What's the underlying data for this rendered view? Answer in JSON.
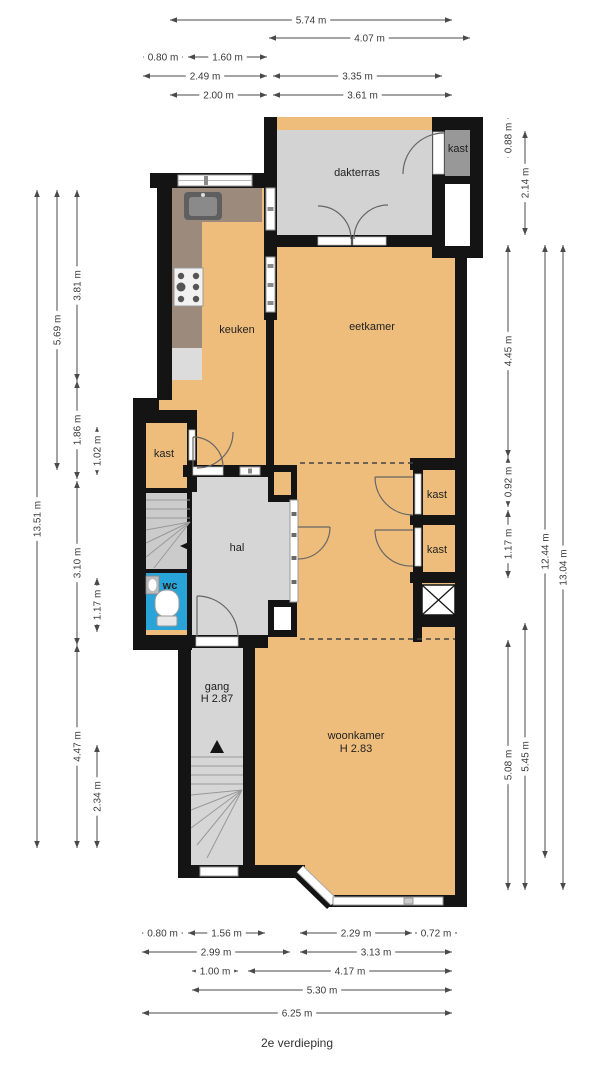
{
  "title": "2e verdieping",
  "colors": {
    "floor_orange": "#efbd7b",
    "floor_gray": "#d5d5d5",
    "wall_black": "#141414",
    "counter_taupe": "#9c8b7d",
    "kast_dark_gray": "#989898",
    "wc_blue": "#29a4d9",
    "dimension_text": "#3a3a3a"
  },
  "floor_plan": {
    "room_labels": [
      {
        "text": "dakterras",
        "x": 357,
        "y": 176
      },
      {
        "text": "kast",
        "x": 458,
        "y": 152
      },
      {
        "text": "keuken",
        "x": 237,
        "y": 333
      },
      {
        "text": "eetkamer",
        "x": 372,
        "y": 330
      },
      {
        "text": "kast",
        "x": 164,
        "y": 457
      },
      {
        "text": "hal",
        "x": 237,
        "y": 551
      },
      {
        "text": "wc",
        "x": 170,
        "y": 589,
        "color": "#ffffff",
        "size": 9,
        "bold": true
      },
      {
        "text": "kast",
        "x": 437,
        "y": 498
      },
      {
        "text": "kast",
        "x": 437,
        "y": 553
      },
      {
        "text": "gang",
        "x": 217,
        "y": 690
      },
      {
        "text": "H 2.87",
        "x": 217,
        "y": 702
      },
      {
        "text": "woonkamer",
        "x": 356,
        "y": 739
      },
      {
        "text": "H 2.83",
        "x": 356,
        "y": 752
      }
    ],
    "dimensions": {
      "horizontal": [
        {
          "label": "5.74 m",
          "x1": 170,
          "x2": 452,
          "y": 20
        },
        {
          "label": "4.07 m",
          "x1": 269,
          "x2": 470,
          "y": 38
        },
        {
          "label": "0.80 m",
          "x1": 143,
          "x2": 183,
          "y": 57
        },
        {
          "label": "1.60 m",
          "x1": 188,
          "x2": 267,
          "y": 57
        },
        {
          "label": "2.49 m",
          "x1": 143,
          "x2": 267,
          "y": 76
        },
        {
          "label": "3.35 m",
          "x1": 273,
          "x2": 442,
          "y": 76
        },
        {
          "label": "2.00 m",
          "x1": 170,
          "x2": 267,
          "y": 95
        },
        {
          "label": "3.61 m",
          "x1": 273,
          "x2": 452,
          "y": 95
        },
        {
          "label": "0.80 m",
          "x1": 142,
          "x2": 183,
          "y": 933
        },
        {
          "label": "1.56 m",
          "x1": 188,
          "x2": 265,
          "y": 933
        },
        {
          "label": "2.29 m",
          "x1": 300,
          "x2": 412,
          "y": 933
        },
        {
          "label": "0.72 m",
          "x1": 415,
          "x2": 457,
          "y": 933
        },
        {
          "label": "2.99 m",
          "x1": 142,
          "x2": 290,
          "y": 952
        },
        {
          "label": "3.13 m",
          "x1": 300,
          "x2": 452,
          "y": 952
        },
        {
          "label": "1.00 m",
          "x1": 192,
          "x2": 238,
          "y": 971
        },
        {
          "label": "4.17 m",
          "x1": 248,
          "x2": 452,
          "y": 971
        },
        {
          "label": "5.30 m",
          "x1": 192,
          "x2": 452,
          "y": 990
        },
        {
          "label": "6.25 m",
          "x1": 142,
          "x2": 452,
          "y": 1013
        }
      ],
      "vertical": [
        {
          "label": "13.51 m",
          "x": 37,
          "y1": 190,
          "y2": 848
        },
        {
          "label": "5.69 m",
          "x": 57,
          "y1": 190,
          "y2": 470
        },
        {
          "label": "3.81 m",
          "x": 77,
          "y1": 190,
          "y2": 381
        },
        {
          "label": "1.86 m",
          "x": 77,
          "y1": 381,
          "y2": 479
        },
        {
          "label": "3.10 m",
          "x": 77,
          "y1": 481,
          "y2": 645
        },
        {
          "label": "4.47 m",
          "x": 77,
          "y1": 645,
          "y2": 848
        },
        {
          "label": "1.02 m",
          "x": 97,
          "y1": 427,
          "y2": 475
        },
        {
          "label": "1.17 m",
          "x": 97,
          "y1": 578,
          "y2": 632
        },
        {
          "label": "2.34 m",
          "x": 97,
          "y1": 745,
          "y2": 848
        },
        {
          "label": "0.88 m",
          "x": 508,
          "y1": 118,
          "y2": 158
        },
        {
          "label": "2.14 m",
          "x": 525,
          "y1": 131,
          "y2": 235
        },
        {
          "label": "4.45 m",
          "x": 508,
          "y1": 245,
          "y2": 457
        },
        {
          "label": "0.92 m",
          "x": 508,
          "y1": 457,
          "y2": 507
        },
        {
          "label": "1.17 m",
          "x": 508,
          "y1": 510,
          "y2": 578
        },
        {
          "label": "5.08 m",
          "x": 508,
          "y1": 640,
          "y2": 890
        },
        {
          "label": "5.45 m",
          "x": 525,
          "y1": 623,
          "y2": 890
        },
        {
          "label": "12.44 m",
          "x": 545,
          "y1": 245,
          "y2": 858
        },
        {
          "label": "13.04 m",
          "x": 563,
          "y1": 245,
          "y2": 890
        }
      ]
    }
  }
}
